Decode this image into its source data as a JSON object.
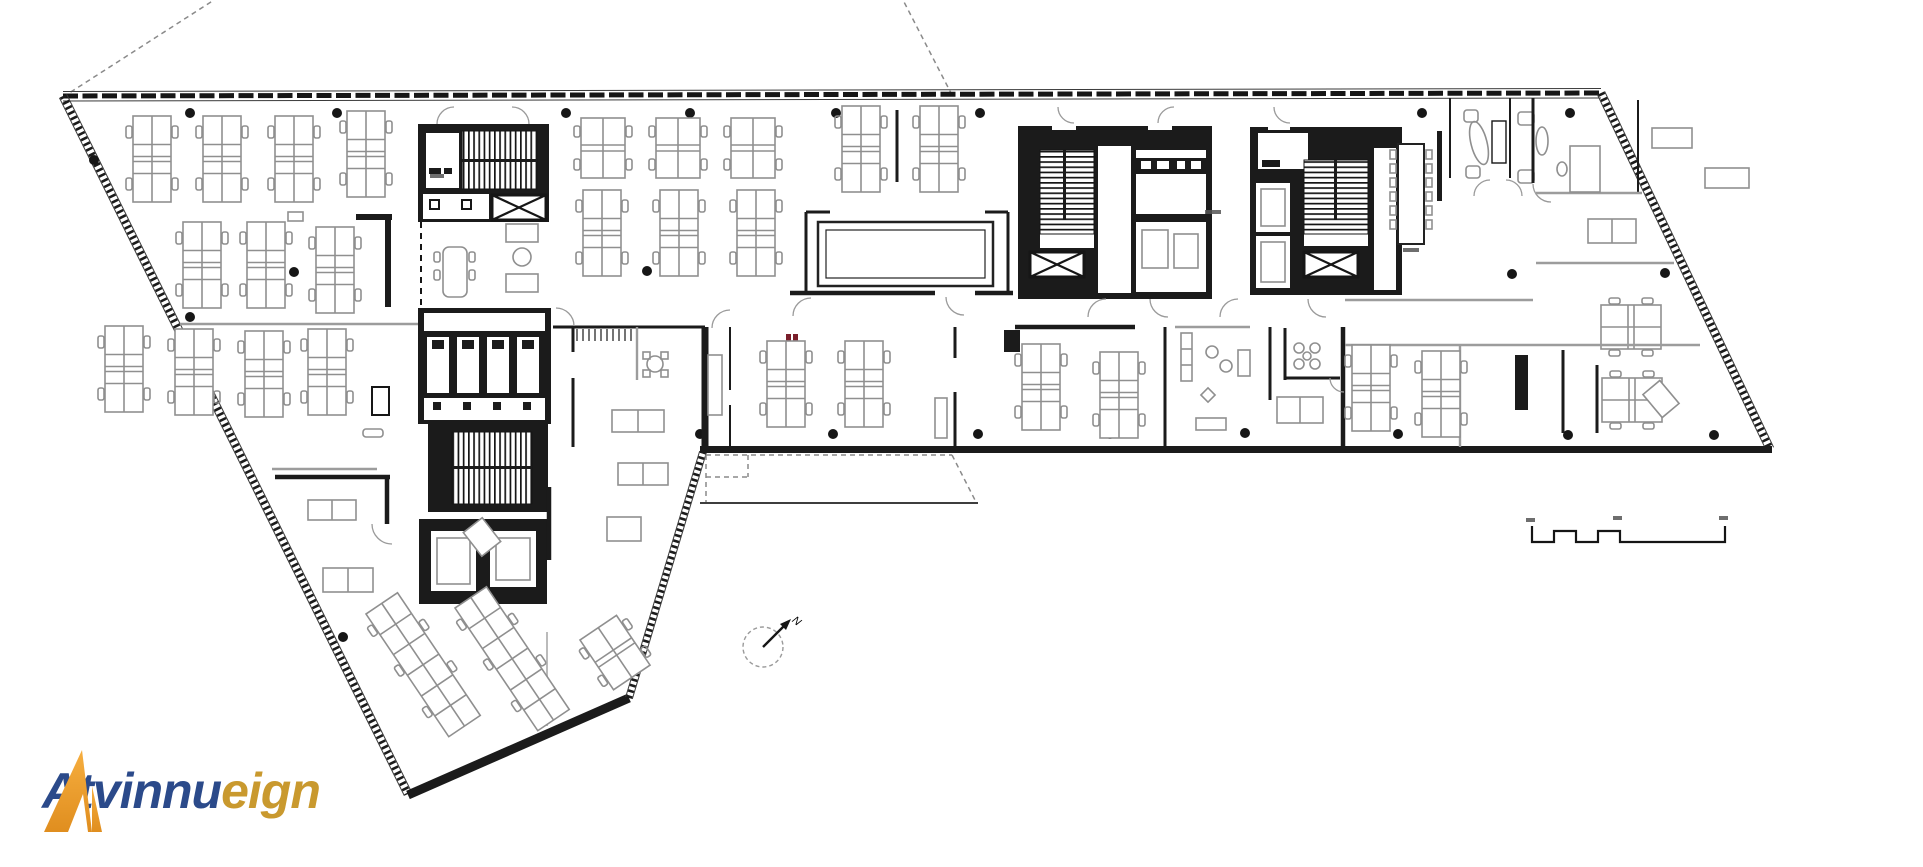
{
  "page": {
    "background": "#ffffff",
    "kind": "architectural floor plan drawing"
  },
  "logo": {
    "mark_icon": "triangle-a-logo",
    "text_primary": "Atvinnu",
    "text_secondary": "eign",
    "colors": {
      "mark_top": "#F6AE3F",
      "mark_bottom": "#E08E1F",
      "primary_text": "#2B4A8A",
      "secondary_text": "#C9992E"
    }
  },
  "plan": {
    "north_arrow_label": "N",
    "colors": {
      "wall": "#1b1b1b",
      "furniture": "#8f8f8f",
      "light_wall": "#9c9c9c",
      "red_annotation": "#7a1f2b"
    },
    "features": [
      "curtain-wall-north",
      "hatched-exterior-wall-west",
      "hatched-exterior-wall-east",
      "stair-core-west",
      "stair-core-center",
      "stair-core-east",
      "wc-block",
      "elevator-shafts",
      "open-plan-desk-clusters",
      "conference-room",
      "conference-table",
      "lounge-furniture",
      "meeting-rooms",
      "terrace-outline",
      "north-arrow-icon",
      "scale-bar",
      "column-grid",
      "site-boundary-lines"
    ]
  }
}
